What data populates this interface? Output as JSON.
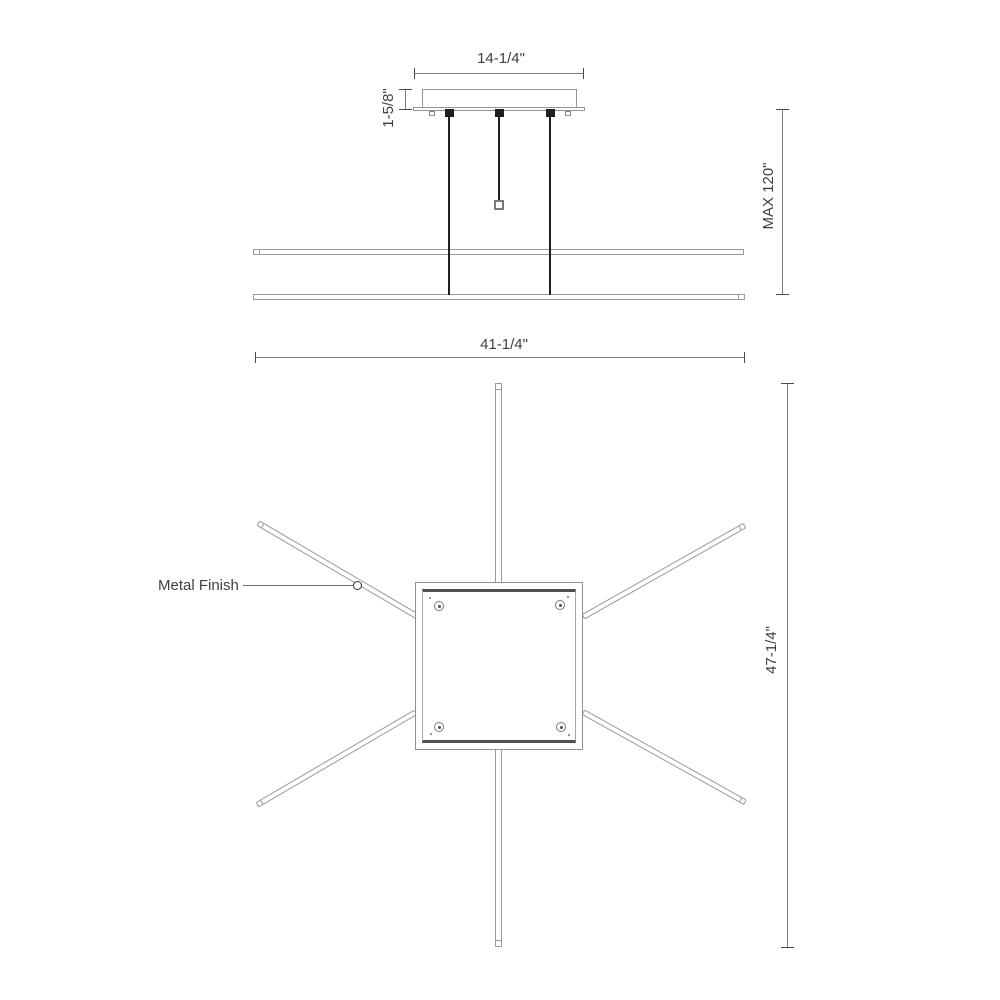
{
  "meta": {
    "drawing_type": "dimension line drawing of linear suspension light fixture",
    "background_color": "#ffffff",
    "outline_color": "#9a9a9a",
    "dimension_line_color": "#7d7d7d",
    "dark_line_color": "#1f1f1f",
    "text_color": "#3f3f3f"
  },
  "side_view": {
    "canopy_width": "14-1/4\"",
    "canopy_height": "1-5/8\"",
    "max_drop": "MAX 120\""
  },
  "plan_view": {
    "overall_width": "41-1/4\"",
    "overall_depth": "47-1/4\"",
    "finish_note": "Metal Finish"
  }
}
